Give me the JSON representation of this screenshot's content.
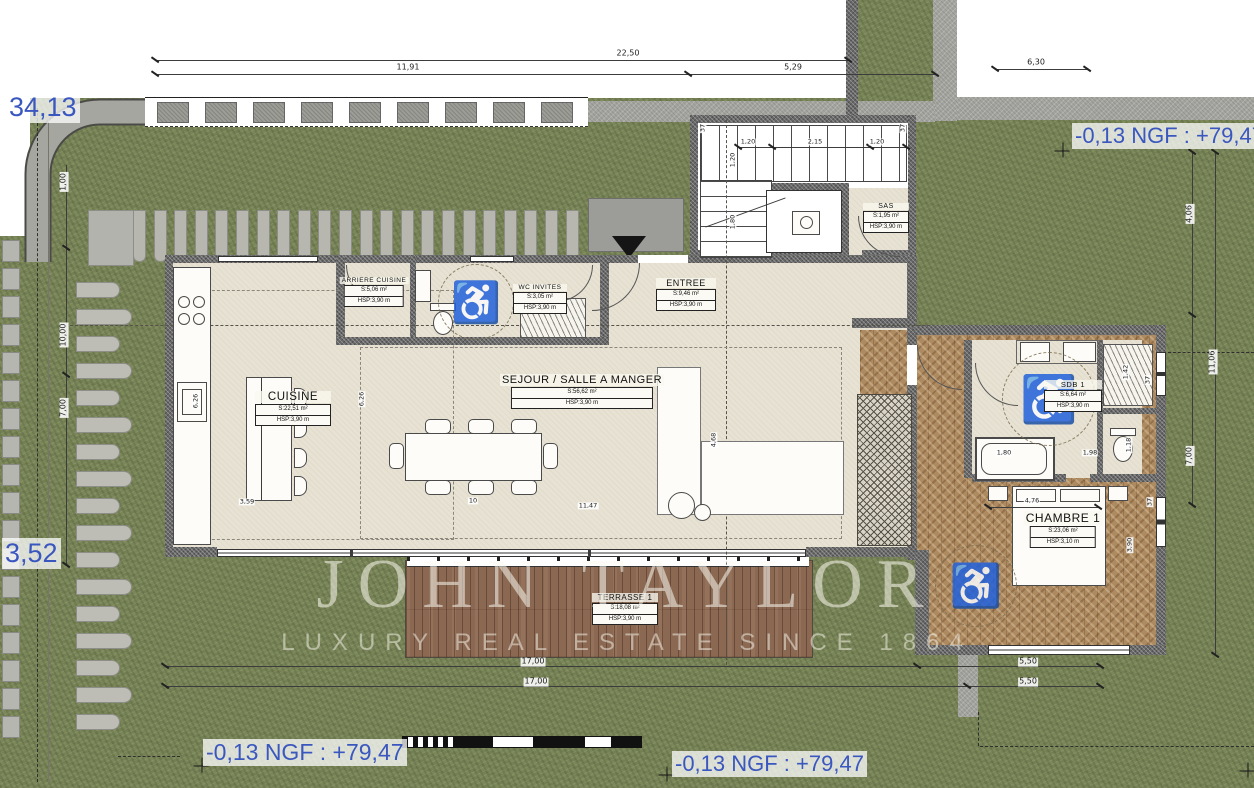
{
  "watermark": {
    "name": "JOHN TAYLOR",
    "tagline": "LUXURY REAL ESTATE SINCE 1864"
  },
  "annotations": {
    "boundary_left_top": "34,13",
    "boundary_left_bottom": "3,52",
    "level_top_right": "-0,13 NGF : +79,47",
    "level_bottom_left": "-0,13 NGF : +79,47",
    "level_bottom_center": "-0,13 NGF : +79,47"
  },
  "rooms": {
    "cuisine": {
      "name": "CUISINE",
      "area": "S:22,51 m²",
      "height": "HSP:3,90 m"
    },
    "arriere_cuisine": {
      "name": "ARRIERE CUISINE",
      "area": "S:5,06 m²",
      "height": "HSP:3,90 m"
    },
    "wc_invites": {
      "name": "WC INVITES",
      "area": "S:3,05 m²",
      "height": "HSP:3,90 m"
    },
    "entree": {
      "name": "ENTREE",
      "area": "S:9,46 m²",
      "height": "HSP:3,90 m"
    },
    "sas": {
      "name": "SAS",
      "area": "S:1,95 m²",
      "height": "HSP:3,90 m"
    },
    "sejour": {
      "name": "SEJOUR / SALLE A MANGER",
      "area": "S:56,62 m²",
      "height": "HSP:3,90 m"
    },
    "sdb1": {
      "name": "SDB 1",
      "area": "S:6,64 m²",
      "height": "HSP:3,90 m"
    },
    "chambre1": {
      "name": "CHAMBRE 1",
      "area": "S:23,06 m²",
      "height": "HSP:3,10 m"
    },
    "terrasse1": {
      "name": "TERRASSE 1",
      "area": "S:18,08 m²",
      "height": "HSP:3,90 m"
    }
  },
  "dims": {
    "top_total": "22,50",
    "top_left": "11,91",
    "top_right": "5,29",
    "top_far_right": "6,30",
    "left_offset": "1,00",
    "left_upper": "10,00",
    "left_lower": "7,00",
    "right_upper": "4,06",
    "right_mid": "11,06",
    "right_lower": "7,00",
    "bottom_a1": "17,00",
    "bottom_a2": "5,50",
    "bottom_b1": "17,00",
    "bottom_b2": "5,50",
    "stair_w1": "1,20",
    "stair_w2": "2,15",
    "stair_w3": "1,20",
    "stair_v1": "1,20",
    "stair_v2": "1,80",
    "kitchen_island": "3,59",
    "kitchen_depth": "6,26",
    "sejour_depth": "6,26",
    "sejour_width": "11,47",
    "sejour_side": "4,68",
    "bed_width": "4,76",
    "bath_tub": "1,80",
    "bath_wc": "1,98",
    "bath_v1": "1,42",
    "bath_v2": "3,06",
    "bath_v3": "1,18",
    "chambre_side": "3,90",
    "wall_t1": "37",
    "wall_t2": "37",
    "wall_t3": "37",
    "wall_t4": "37",
    "wall_gap": "10"
  },
  "colors": {
    "annotation_blue": "#3a57bf",
    "grass_green": "#7b8759",
    "floor_beige": "#e7e2d3",
    "deck_brown": "#8b6852",
    "parquet_brown": "#ad8a60",
    "road_gray": "#a5a5a0"
  }
}
